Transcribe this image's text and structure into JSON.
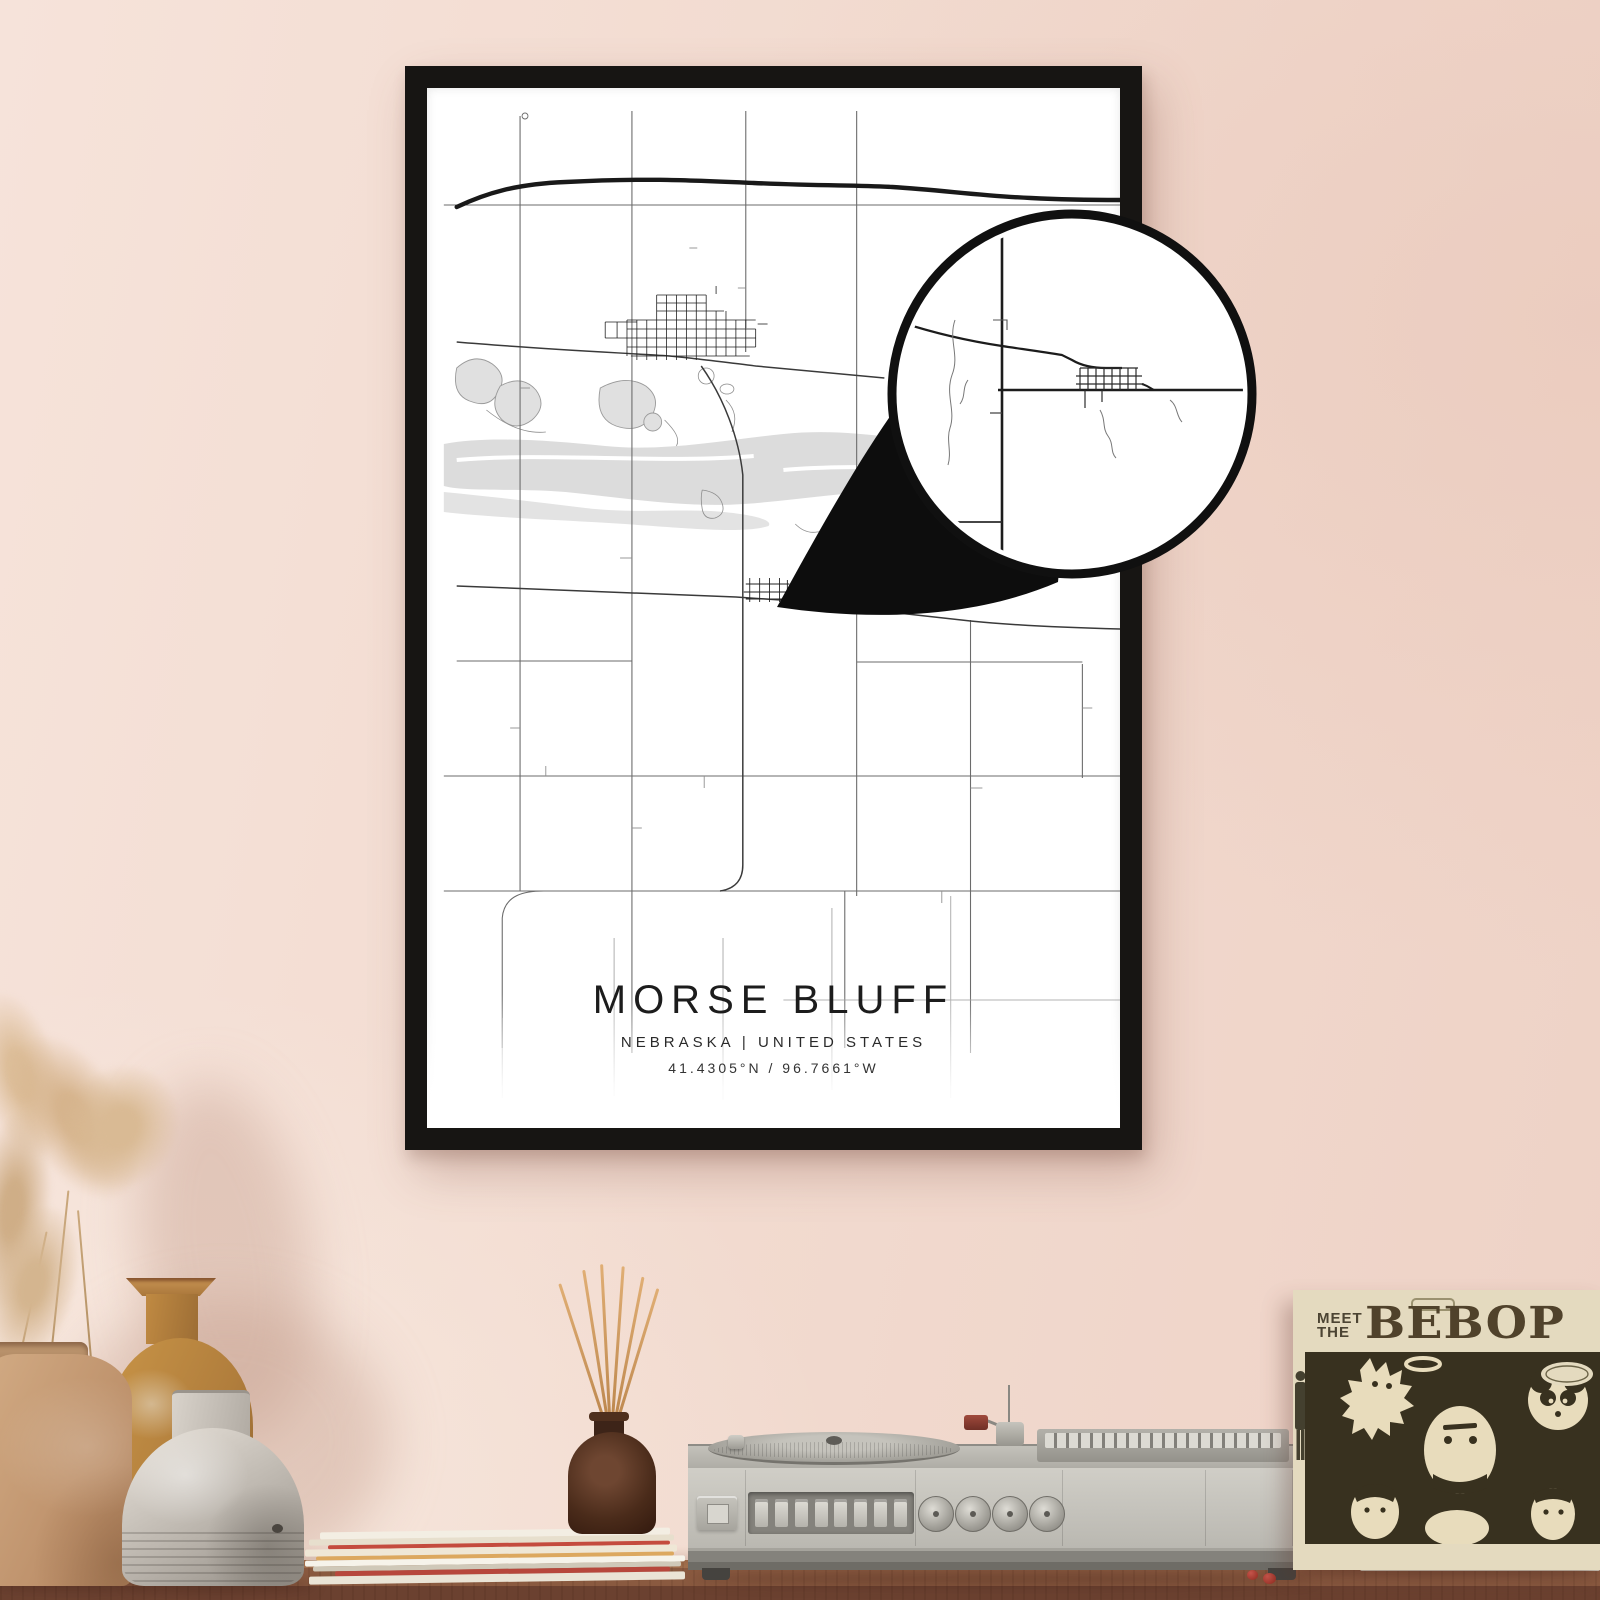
{
  "scene": {
    "wall_color_top": "#f2dbd0",
    "wall_color_bottom": "#f6e9df",
    "table_color": "#8a5a40"
  },
  "poster": {
    "title": "MORSE BLUFF",
    "region_line": "NEBRASKA | UNITED STATES",
    "coordinates": "41.4305°N / 96.7661°W",
    "frame_color": "#171513",
    "paper_color": "#ffffff",
    "road_color": "#2b2b2b",
    "water_color": "#dcdcdc"
  },
  "zoom_callout": {
    "ring_color": "#101010",
    "fill_color": "#ffffff"
  },
  "record_sleeve": {
    "title_word1": "MEET",
    "title_word2": "THE",
    "title_main": "BEBOP",
    "cover_color": "#e4dabf",
    "art_color": "#38311f"
  },
  "record_player": {
    "body_color": "#c9c7c0",
    "knob_count": 4,
    "button_count": 8
  },
  "decor": {
    "diffuser_color": "#4a2b1a",
    "vase_colors": [
      "#c7a07c",
      "#bf8c45",
      "#c2bcb3"
    ],
    "pampas_color": "#d8b893"
  }
}
